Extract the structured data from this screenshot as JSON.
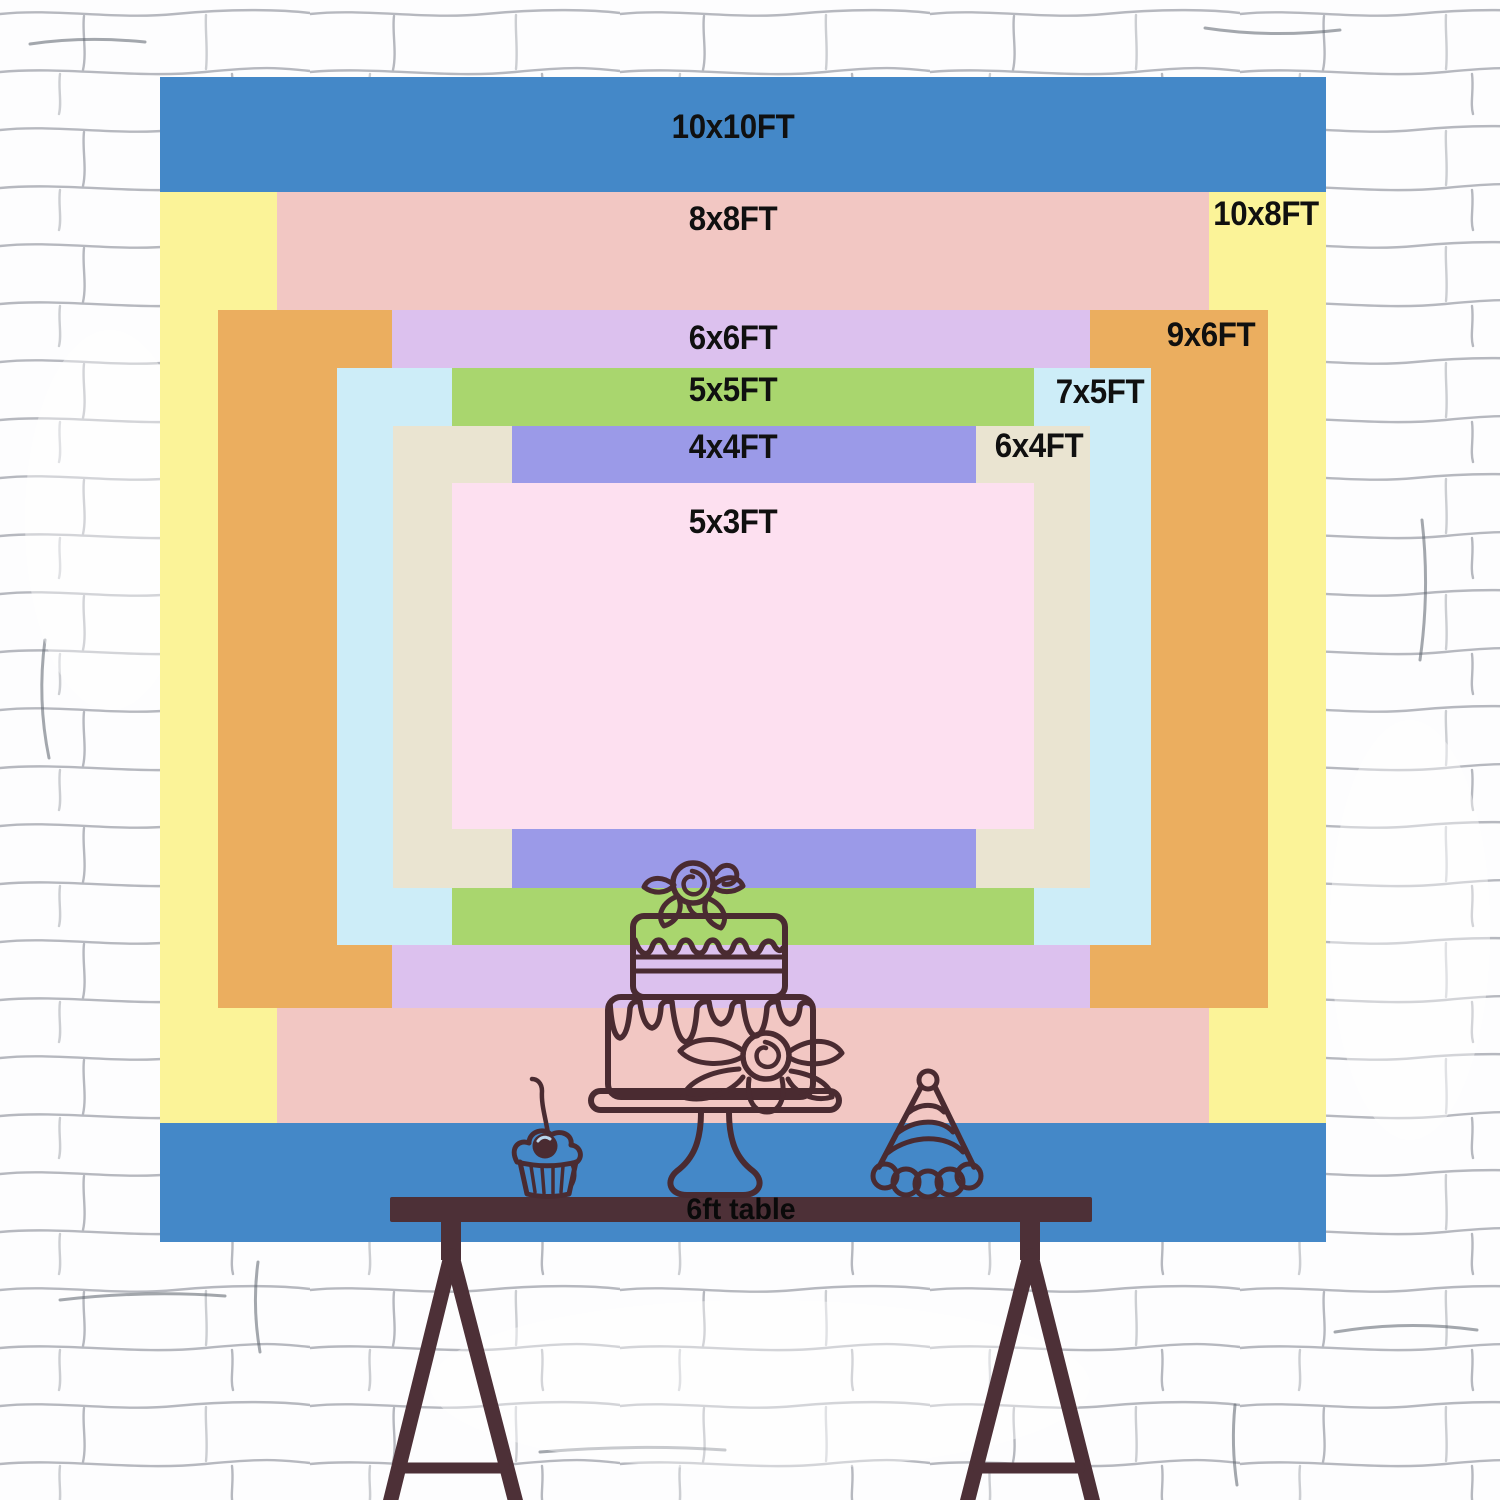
{
  "sizes": [
    {
      "label": "10x10FT",
      "width_ft": 10,
      "height_ft": 10,
      "color": "#4488c8"
    },
    {
      "label": "10x8FT",
      "width_ft": 10,
      "height_ft": 8,
      "color": "#fbf398"
    },
    {
      "label": "8x8FT",
      "width_ft": 8,
      "height_ft": 8,
      "color": "#f2c7c3"
    },
    {
      "label": "9x6FT",
      "width_ft": 9,
      "height_ft": 6,
      "color": "#ebae5f"
    },
    {
      "label": "6x6FT",
      "width_ft": 6,
      "height_ft": 6,
      "color": "#dcc1ee"
    },
    {
      "label": "7x5FT",
      "width_ft": 7,
      "height_ft": 5,
      "color": "#cdedf8"
    },
    {
      "label": "5x5FT",
      "width_ft": 5,
      "height_ft": 5,
      "color": "#a9d66e"
    },
    {
      "label": "6x4FT",
      "width_ft": 6,
      "height_ft": 4,
      "color": "#eae4d1"
    },
    {
      "label": "4x4FT",
      "width_ft": 4,
      "height_ft": 4,
      "color": "#9b9ae8"
    },
    {
      "label": "5x3FT",
      "width_ft": 5,
      "height_ft": 3,
      "color": "#fde0f0"
    }
  ],
  "table": {
    "label": "6ft table",
    "color": "#4d3037"
  },
  "artwork": {
    "stroke": "#4a2b31",
    "icons": [
      "tiered-cake",
      "cupcake",
      "party-hat"
    ]
  },
  "wall": {
    "base": "#fdfdfe",
    "line": "#7b808a",
    "accent": "#596069"
  }
}
